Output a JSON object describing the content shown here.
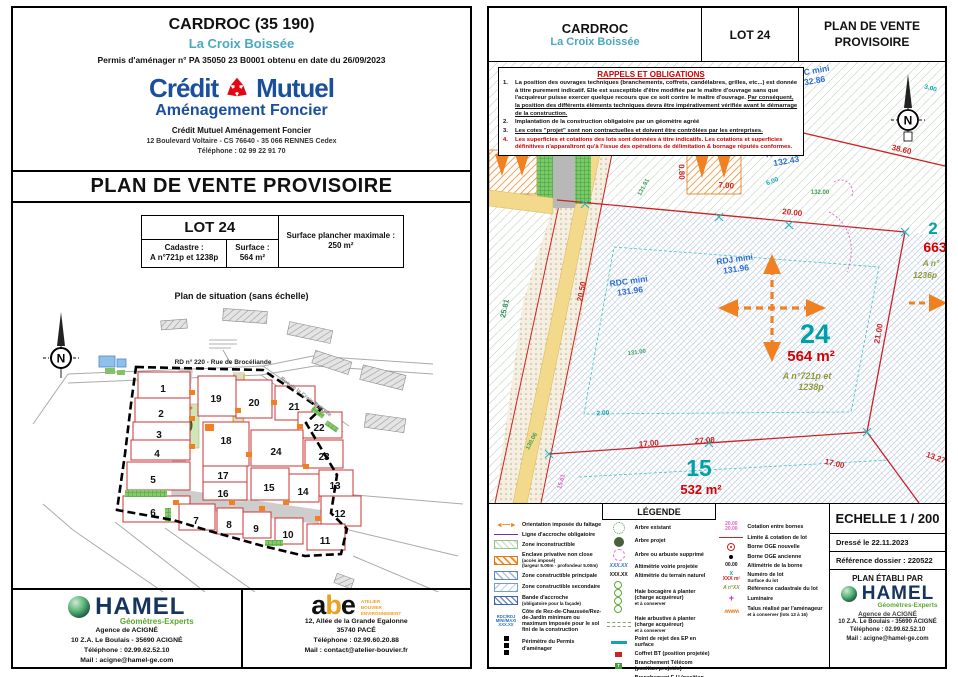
{
  "colors": {
    "teal": "#4aa8bf",
    "navy": "#1a4f9c",
    "red": "#cc2222",
    "orange": "#f08020",
    "lot_teal": "#00a0a8",
    "olive": "#8f9a3a",
    "level_blue": "#2a6fd0"
  },
  "left": {
    "header": {
      "title": "CARDROC (35 190)",
      "subtitle": "La Croix Boissée",
      "permit": "Permis d'aménager n° PA 35050 23 B0001 obtenu en date du 26/09/2023",
      "brand_left": "Crédit",
      "brand_right": "Mutuel",
      "brand_sub": "Aménagement Foncier",
      "org": "Crédit Mutuel Aménagement Foncier",
      "address": "12 Boulevard Voltaire - CS 76640 - 35 066 RENNES Cedex",
      "phone": "Téléphone : 02 99 22 91 70"
    },
    "banner": "PLAN DE VENTE PROVISOIRE",
    "lot_table": {
      "lot": "LOT 24",
      "cadastre_label": "Cadastre :",
      "cadastre_value": "A n°721p et 1238p",
      "surface_label": "Surface :",
      "surface_value": "564 m²",
      "floor_label": "Surface plancher maximale :",
      "floor_value": "250 m²"
    },
    "situation_caption": "Plan de situation (sans échelle)",
    "site_plan": {
      "north": "N",
      "street": "RD  n° 220 - Rue de Brocéliande",
      "street2": "Rue de la Croix Boissée",
      "lots": [
        "1",
        "2",
        "3",
        "4",
        "5",
        "6",
        "7",
        "8",
        "9",
        "10",
        "11",
        "12",
        "13",
        "14",
        "15",
        "16",
        "17",
        "18",
        "19",
        "20",
        "21",
        "22",
        "23",
        "24"
      ]
    },
    "footer": {
      "hamel": {
        "name": "HAMEL",
        "tagline": "Géomètres-Experts",
        "agency": "Agence de ACIGNÉ",
        "address": "10 Z.A. Le Boulais - 35690 ACIGNÉ",
        "phone": "Téléphone : 02.99.62.52.10",
        "mail": "Mail : acigne@hamel-ge.com"
      },
      "abe": {
        "logo": "abe",
        "tag1": "ATELIER",
        "tag2": "BOUVIER",
        "tag3": "ENVIRONNEMENT",
        "address": "12, Allée de la Grande Egalonne",
        "city": "35740 PACÉ",
        "phone": "Téléphone : 02.99.60.20.88",
        "mail": "Mail : contact@atelier-bouvier.fr"
      }
    }
  },
  "right": {
    "header": {
      "title": "CARDROC",
      "subtitle": "La Croix Boissée",
      "lot": "LOT 24",
      "doc": "PLAN DE VENTE PROVISOIRE"
    },
    "rappels": {
      "title": "RAPPELS ET OBLIGATIONS",
      "n1": "1.",
      "n2": "2.",
      "n3": "3.",
      "n4": "4.",
      "item1a": "La position des ouvrages techniques (branchements, coffrets, candélabres, grilles, etc...) est donnée à titre purement indicatif. Elle est susceptible d'être modifiée par le maître d'ouvrage sans que l'acquéreur puisse exercer quelque recours que ce soit contre le maître d'ouvrage. ",
      "item1b": "Par conséquent, la position des différents éléments techniques devra être impérativement vérifiée avant le démarrage de la construction.",
      "item2": "Implantation de la construction obligatoire par un géomètre agréé",
      "item3": "Les cotes \"projet\" sont non contractuelles et doivent être contrôlées par les entreprises.",
      "item4": "Les superficies et cotations des lots sont données à titre indicatifs. Les cotations et superficies définitives n'apparaîtront qu'à l'issue des opérations de délimitation & bornage réputés conformes."
    },
    "plan": {
      "north": "N",
      "lot24_num": "24",
      "lot24_area": "564 m²",
      "lot24_cad1": "A n°721p et",
      "lot24_cad2": "1238p",
      "lot15_num": "15",
      "lot15_area": "532 m²",
      "lotr_num": "2",
      "lotr_area": "663",
      "lotr_cad1": "A n°",
      "lotr_cad2": "1236p",
      "rdj1": "RDJ mini",
      "rdj1v": "131.96",
      "rdc1": "RDC mini",
      "rdc1v": "131.96",
      "rdc2": "RDC mini",
      "rdc2v": "132.43",
      "rdc3": "RDC mini",
      "rdc3v": "132.86",
      "d_2000": "20.00",
      "d_2100": "21.00",
      "d_3860": "38.60",
      "d_1700": "17.00",
      "d_2700": "27.00",
      "d_700": "7.00",
      "d_2581": "25.81",
      "d_2050": "20.50",
      "d_300": "3.00",
      "d_1327": "13.27",
      "d_080": "0.80",
      "d_200": "2.00",
      "d_600": "6.00",
      "d_1700b": "17.00",
      "a_13191": "131.91",
      "a_13100": "131.00",
      "a_13006": "130.06",
      "a_13200": "132.00",
      "a_1561": "15.61"
    },
    "legend": {
      "title": "LÉGENDE",
      "col1": [
        {
          "label": "Orientation imposée du faîtage"
        },
        {
          "label": "Ligne d'accroche obligatoire"
        },
        {
          "label": "Zone inconstructible"
        },
        {
          "label": "Enclave privative non close",
          "sub": "(accès imposé)",
          "sub2": "(largeur 5.00m - profondeur 5.00m)"
        },
        {
          "label": "Zone constructible principale"
        },
        {
          "label": "Zone constructible secondaire"
        },
        {
          "label": "Bande d'accroche",
          "sub": "(obligatoire pour la façade)"
        },
        {
          "label": "Côte de Rez-de-Chaussée/Rez-de-Jardin minimum ou maximum imposée pour le sol fini de la construction"
        },
        {
          "label": "Périmètre du Permis d'aménager"
        }
      ],
      "col2": [
        {
          "label": "Arbre existant"
        },
        {
          "label": "Arbre projet"
        },
        {
          "label": "Arbre ou arbuste supprimé"
        },
        {
          "label": "Altimétrie voirie projetée"
        },
        {
          "label": "Altimétrie du terrain naturel"
        },
        {
          "label": "Haie bocagère à planter (charge acquéreur)",
          "sub": "et à conserver"
        },
        {
          "label": "Haie arbustive à planter (charge acquéreur)",
          "sub": "et à conserver"
        },
        {
          "label": "Point de rejet des EP en surface"
        },
        {
          "label": "Coffret BT (position projetée)"
        },
        {
          "label": "Branchement Télécom (position projetée)"
        },
        {
          "label": "Branchement E.U (position projetée)"
        },
        {
          "label": "Coffret A.E.P (position projetée)"
        }
      ],
      "col3": [
        {
          "label": "Cotation entre bornes"
        },
        {
          "label": "Limite & cotation de lot"
        },
        {
          "label": "Borne OGE nouvelle"
        },
        {
          "label": "Borne OGE ancienne"
        },
        {
          "label": "Altimétrie de la borne"
        },
        {
          "label": "Numéro de lot",
          "sub": "Surface du lot"
        },
        {
          "label": "Référence cadastrale du lot"
        },
        {
          "label": "Luminaire"
        },
        {
          "label": "Talus réalisé par l'aménageur",
          "sub": "et à conserver (lots 13 à 16)"
        }
      ],
      "sym": {
        "rdc1": "RDC/RDJ",
        "rdc2": "MINI/MAXI",
        "rdc3": "XXX.XX",
        "xxx": "XXX.XX",
        "cot1": "20.00",
        "cot2": "20.00",
        "alti": "00.00",
        "num": "X",
        "surf": "XXX m²",
        "cad": "A n°XX",
        "lum": "+",
        "bt": "BT",
        "t": "T"
      }
    },
    "infobox": {
      "scale": "ECHELLE 1 / 200",
      "date": "Dressé le 22.11.2023",
      "ref": "Référence dossier : 220522",
      "established": "PLAN ÉTABLI PAR",
      "hamel": {
        "name": "HAMEL",
        "tagline": "Géomètres-Experts",
        "agency": "Agence de ACIGNÉ",
        "address": "10 Z.A. Le Boulais - 35690 ACIGNÉ",
        "phone": "Téléphone : 02.99.62.52.10",
        "mail": "Mail : acigne@hamel-ge.com"
      }
    }
  }
}
